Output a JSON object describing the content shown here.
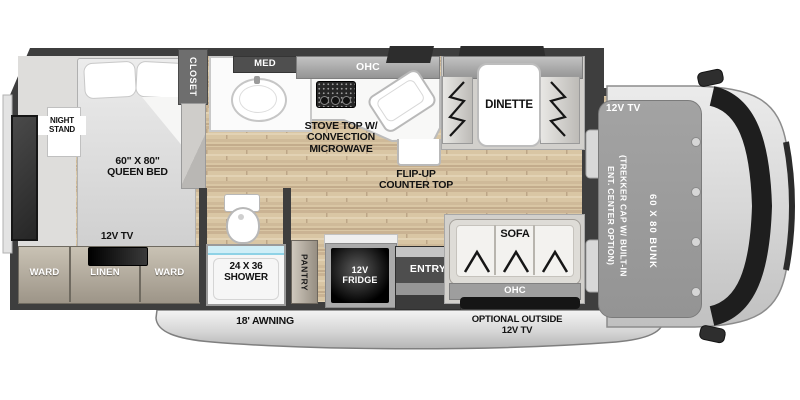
{
  "plan": {
    "bedroom": {
      "night_stand": "NIGHT STAND",
      "bed_size": "60\" X 80\"",
      "bed_type": "QUEEN BED",
      "tv": "12V TV",
      "ward_left": "WARD",
      "linen": "LINEN",
      "ward_right": "WARD",
      "closet": "CLOSET"
    },
    "bath": {
      "med": "MED",
      "shower_size": "24 X 36",
      "shower": "SHOWER"
    },
    "kitchen": {
      "ohc": "OHC",
      "stove1": "STOVE TOP W/",
      "stove2": "CONVECTION",
      "stove3": "MICROWAVE",
      "flip1": "FLIP-UP",
      "flip2": "COUNTER TOP",
      "pantry": "PANTRY",
      "fridge1": "12V",
      "fridge2": "FRIDGE"
    },
    "dinette": {
      "ohc": "OHC",
      "label": "DINETTE"
    },
    "living": {
      "sofa": "SOFA",
      "ohc": "OHC",
      "entry": "ENTRY"
    },
    "cab": {
      "tv": "12V TV",
      "trekker1": "(TREKKER CAP W/ BUILT-IN",
      "trekker2": "ENT. CENTER OPTION)",
      "bunk": "60 X 80 BUNK"
    },
    "exterior": {
      "awning": "18' AWNING",
      "opt_tv1": "OPTIONAL OUTSIDE",
      "opt_tv2": "12V TV"
    }
  },
  "colors": {
    "wall": "#3e3e3e",
    "wood_floor": "#d9c6a4",
    "slide_floor": "#d2d0cc",
    "cabinet_tan": "#b3a896",
    "accent_water": "#bfe8f2",
    "label_dark": "#121212",
    "label_light": "#ffffff"
  }
}
